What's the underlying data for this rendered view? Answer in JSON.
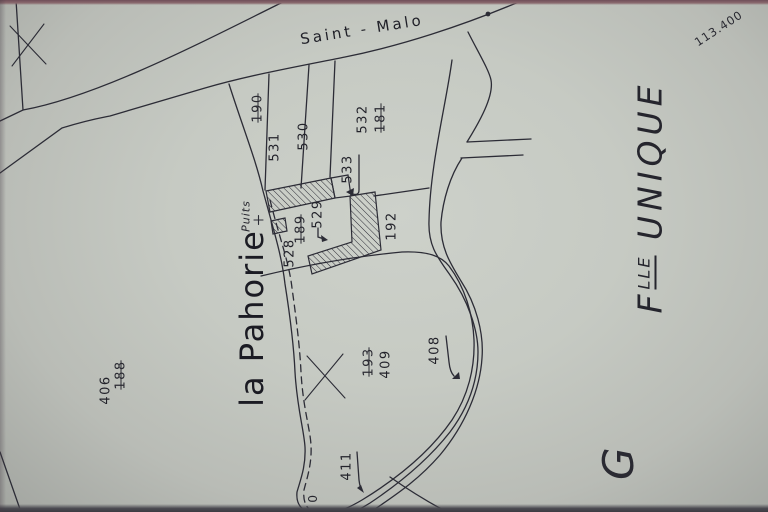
{
  "map": {
    "road_name": "Saint - Malo",
    "locality": "la Pahorie",
    "well_label": "Puits",
    "coordinate_note": "113.400",
    "sheet_label": {
      "f": "F",
      "sup": "LLE",
      "rest": "UNIQUE"
    },
    "section_letter": "G",
    "edge_partial_number": "0"
  },
  "parcels": {
    "current": {
      "n531": "531",
      "n530": "530",
      "n532": "532",
      "n533": "533",
      "n529": "529",
      "n528": "528",
      "n192": "192",
      "n406": "406",
      "n409": "409",
      "n408": "408",
      "n411": "411"
    },
    "former_crossed_out": {
      "n190": "190",
      "n181": "181",
      "n189": "189",
      "n188": "188",
      "n193": "193"
    }
  },
  "colors": {
    "paper": "#c6cac3",
    "ink": "#2c2c36",
    "text": "#23232b",
    "photo_edge_top": "#6f4e59",
    "photo_edge_bottom": "#3c3b42"
  }
}
